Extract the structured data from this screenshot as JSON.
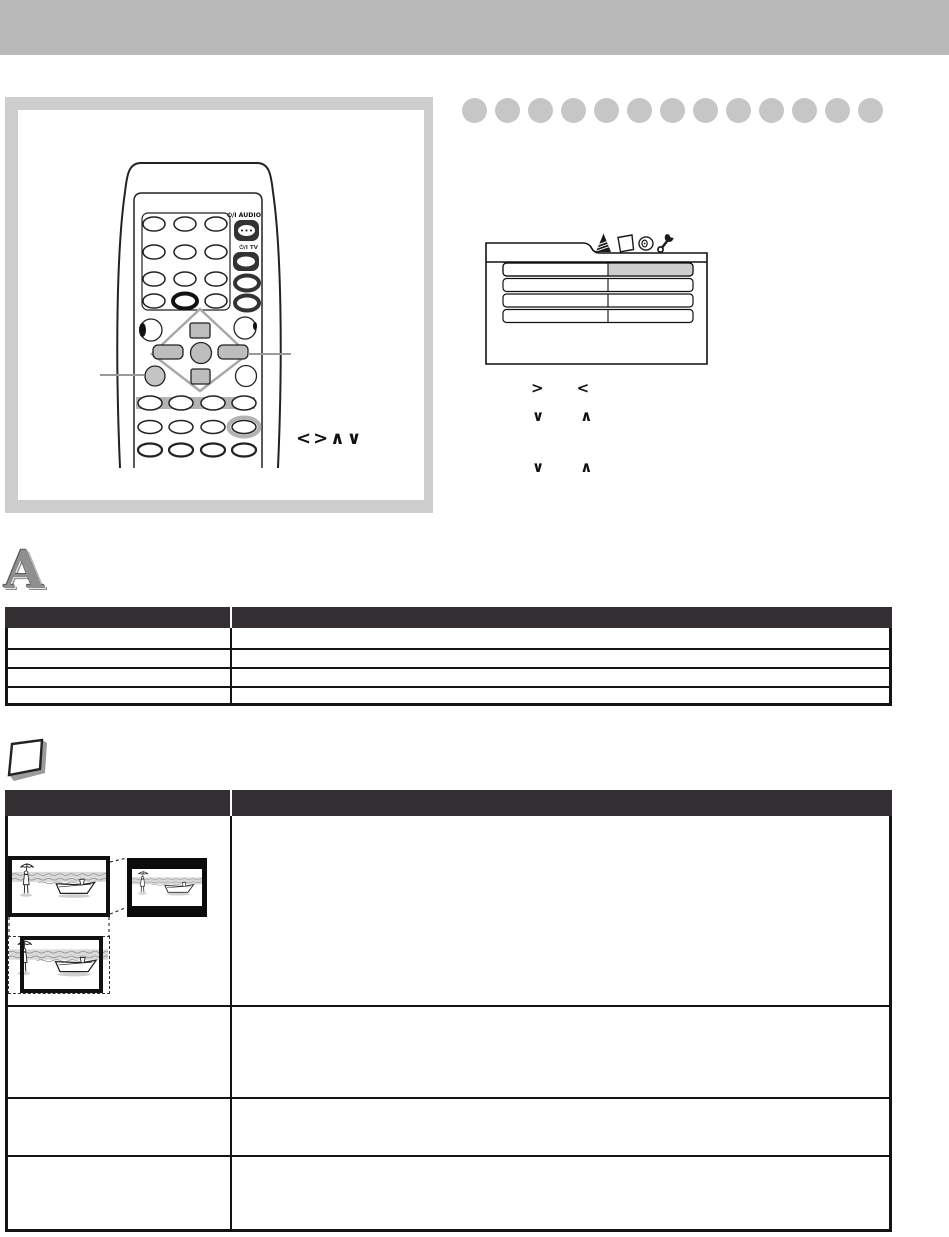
{
  "page": {
    "header_bar_text": ""
  },
  "remote": {
    "power_audio_label": "⏻/I AUDIO",
    "power_tv_label": "⏻/I TV",
    "nav_callout_label": "<>∧∨"
  },
  "osd_menu": {
    "tab_icons": [
      "language-tab-icon",
      "display-tab-icon",
      "audio-tab-icon",
      "setup-tab-icon"
    ],
    "rows": [
      {
        "label": "",
        "value": "",
        "highlighted": true
      },
      {
        "label": "",
        "value": "",
        "highlighted": false
      },
      {
        "label": "",
        "value": "",
        "highlighted": false
      },
      {
        "label": "",
        "value": "",
        "highlighted": false
      }
    ]
  },
  "instructions": {
    "line1": {
      "a": ">",
      "b": "<"
    },
    "line2": {
      "a": "∨",
      "b": "∧"
    },
    "line3": {
      "a": "∨",
      "b": "∧"
    }
  },
  "sections": {
    "language": {
      "drop_cap": "A",
      "table": {
        "headers": [
          "",
          ""
        ],
        "rows": [
          [
            "",
            ""
          ],
          [
            "",
            ""
          ],
          [
            "",
            ""
          ],
          [
            "",
            ""
          ]
        ]
      }
    },
    "display": {
      "table": {
        "headers": [
          "",
          ""
        ],
        "rows": [
          [
            "",
            ""
          ],
          [
            "",
            ""
          ],
          [
            "",
            ""
          ],
          [
            "",
            ""
          ]
        ]
      }
    }
  },
  "colors": {
    "header_bar": "#b9b9b9",
    "panel_background": "#cecece",
    "bullet_dot": "#c6c6c6",
    "table_header": "#322e31",
    "menu_highlight": "#cdcdcd"
  }
}
